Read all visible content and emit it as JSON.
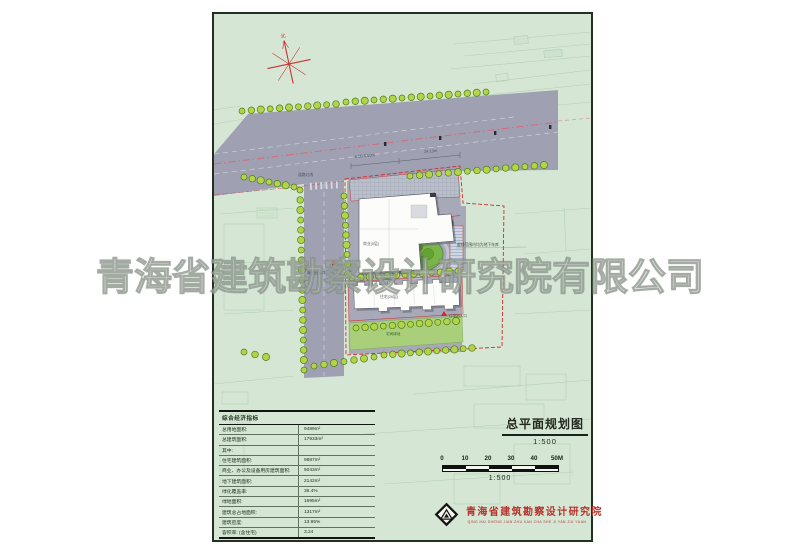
{
  "watermark": {
    "text": "青海省建筑勘察设计研究院有限公司"
  },
  "plan": {
    "north_label": "北",
    "road_redline_label": "道路红线",
    "dim_lane": "5.05  6.60m",
    "dim_frontage": "34.13m",
    "commercial_building_label": "商业(5层)",
    "residential_building_label": "住宅(26层)",
    "commercial_entrance_label": "商业出入口",
    "garage_entrance_label": "地下车库出入口",
    "residential_entrance_label": "住宅出入口",
    "green_strip_label": "宅间绿地",
    "garage_note": "虚线范围内均为地下车库"
  },
  "table": {
    "title": "综合经济指标",
    "rows": [
      {
        "label": "总用地面积:",
        "value": "9489m²"
      },
      {
        "label": "总建筑面积:",
        "value": "17933m²"
      },
      {
        "label": "其中:",
        "value": ""
      },
      {
        "label": "住宅建筑面积:",
        "value": "9887m²"
      },
      {
        "label": "商业、办公及设备用房建筑面积:",
        "value": "5043m²"
      },
      {
        "label": "地下建筑面积:",
        "value": "2142m²"
      },
      {
        "label": "绿化覆盖率:",
        "value": "36.4%"
      },
      {
        "label": "绿地面积:",
        "value": "1695m²"
      },
      {
        "label": "建筑总占地面积:",
        "value": "1317m²"
      },
      {
        "label": "建筑密度:",
        "value": "13.95%"
      },
      {
        "label": "容积率: (含住宅)",
        "value": "3.24"
      }
    ]
  },
  "titleblock": {
    "title": "总平面规划图",
    "scale": "1:500"
  },
  "scalebar": {
    "ticks": [
      "0",
      "10",
      "20",
      "30",
      "40",
      "50M"
    ],
    "scale_label": "1:500"
  },
  "publisher": {
    "name": "青海省建筑勘察设计研究院",
    "pinyin": "QING HAI SHENG JIAN ZHU KAN CHA SHE JI YAN JIU YUAN"
  },
  "colors": {
    "sheet_green": "#d5e7d4",
    "road_gray": "#9fa1b2",
    "tree_green": "#b3d348",
    "boundary_red": "#cc2d2d",
    "garden_green": "#79b548",
    "brand_red": "#b7322c"
  }
}
